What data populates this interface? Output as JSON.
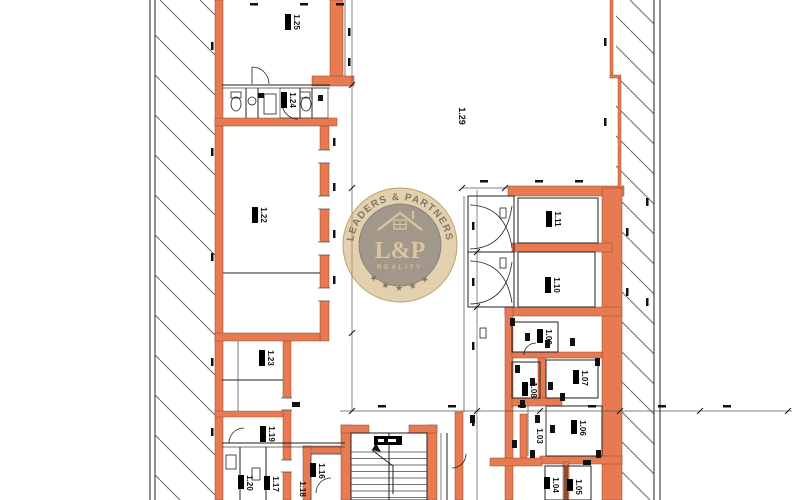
{
  "watermark": {
    "arc_text": "LEADERS & PARTNERS",
    "monogram": "L&P",
    "tagline": "REALITY",
    "stars": "★ ★ ★ ★ ★"
  },
  "rooms": [
    {
      "id": "1.25"
    },
    {
      "id": "1.24"
    },
    {
      "id": "1.22"
    },
    {
      "id": "1.23"
    },
    {
      "id": "1.19"
    },
    {
      "id": "1.20"
    },
    {
      "id": "1.17"
    },
    {
      "id": "1.18"
    },
    {
      "id": "1.16"
    },
    {
      "id": "1.29"
    },
    {
      "id": "1.11"
    },
    {
      "id": "1.10"
    },
    {
      "id": "1.09"
    },
    {
      "id": "1.07"
    },
    {
      "id": "1.08"
    },
    {
      "id": "1.06"
    },
    {
      "id": "1.03"
    },
    {
      "id": "1.04"
    },
    {
      "id": "1.05"
    }
  ],
  "colors": {
    "wall_fill": "#e87a52",
    "hatch_line": "#6a6a6a",
    "plan_line": "#222222",
    "watermark_gold": "#c8a666",
    "watermark_inner_disc": "#8c8275"
  }
}
